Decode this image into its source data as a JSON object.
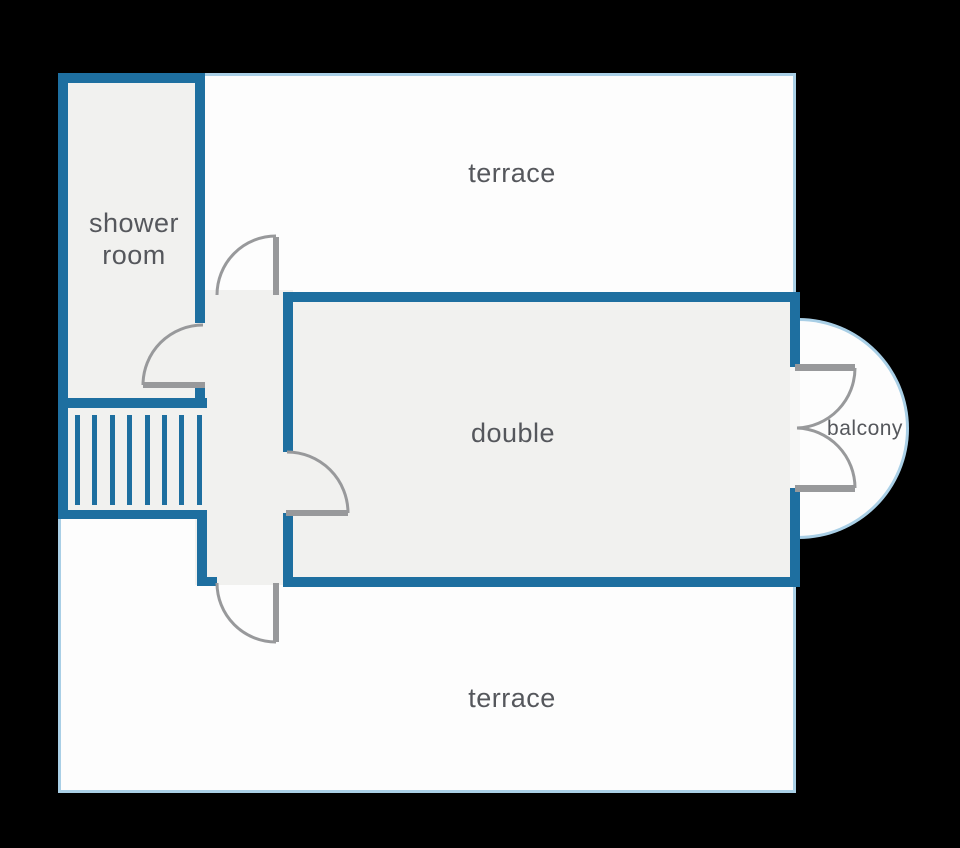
{
  "diagram_type": "floor-plan",
  "colors": {
    "wall_accent": "#1e6fa0",
    "outline_light": "#a9cfe6",
    "room_fill": "#f1f1ef",
    "terrace_fill": "#fdfdfd",
    "door_gray": "#98999b",
    "label_text": "#55575c",
    "background": "#000000"
  },
  "rooms": {
    "shower_room": {
      "label": "shower\nroom"
    },
    "terrace_top": {
      "label": "terrace"
    },
    "double_room": {
      "label": "double"
    },
    "balcony": {
      "label": "balcony"
    },
    "terrace_bottom": {
      "label": "terrace"
    }
  }
}
